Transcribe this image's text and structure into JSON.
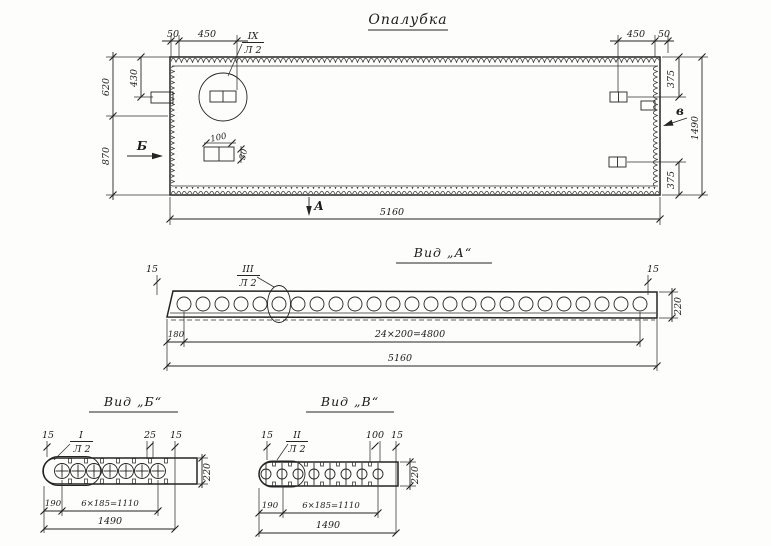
{
  "title": "Опалубка",
  "top": {
    "d50L": "50",
    "d450L": "450",
    "d450R": "450",
    "d50R": "50",
    "d620": "620",
    "d430": "430",
    "d870": "870",
    "d375t": "375",
    "d375b": "375",
    "d1490": "1490",
    "d100": "100",
    "d30": "30",
    "d5160": "5160",
    "calloutNum": "IX",
    "calloutSheet": "Л 2",
    "markLeft": "Б",
    "markRight": "в",
    "markBottom": "А"
  },
  "viewA": {
    "title": "Вид „А“",
    "calloutNum": "III",
    "calloutSheet": "Л 2",
    "d15L": "15",
    "d15R": "15",
    "d220": "220",
    "d180": "180",
    "dSpacing": "24×200=4800",
    "dTotal": "5160"
  },
  "viewB": {
    "title": "Вид „Б“",
    "calloutNum": "I",
    "calloutSheet": "Л 2",
    "d15L": "15",
    "d25": "25",
    "d15R": "15",
    "d220": "220",
    "d190": "190",
    "dSpacing": "6×185=1110",
    "dTotal": "1490"
  },
  "viewV": {
    "title": "Вид „В“",
    "calloutNum": "II",
    "calloutSheet": "Л 2",
    "d15L": "15",
    "d100": "100",
    "d15R": "15",
    "d220": "220",
    "d190": "190",
    "dSpacing": "6×185=1110",
    "dTotal": "1490"
  }
}
